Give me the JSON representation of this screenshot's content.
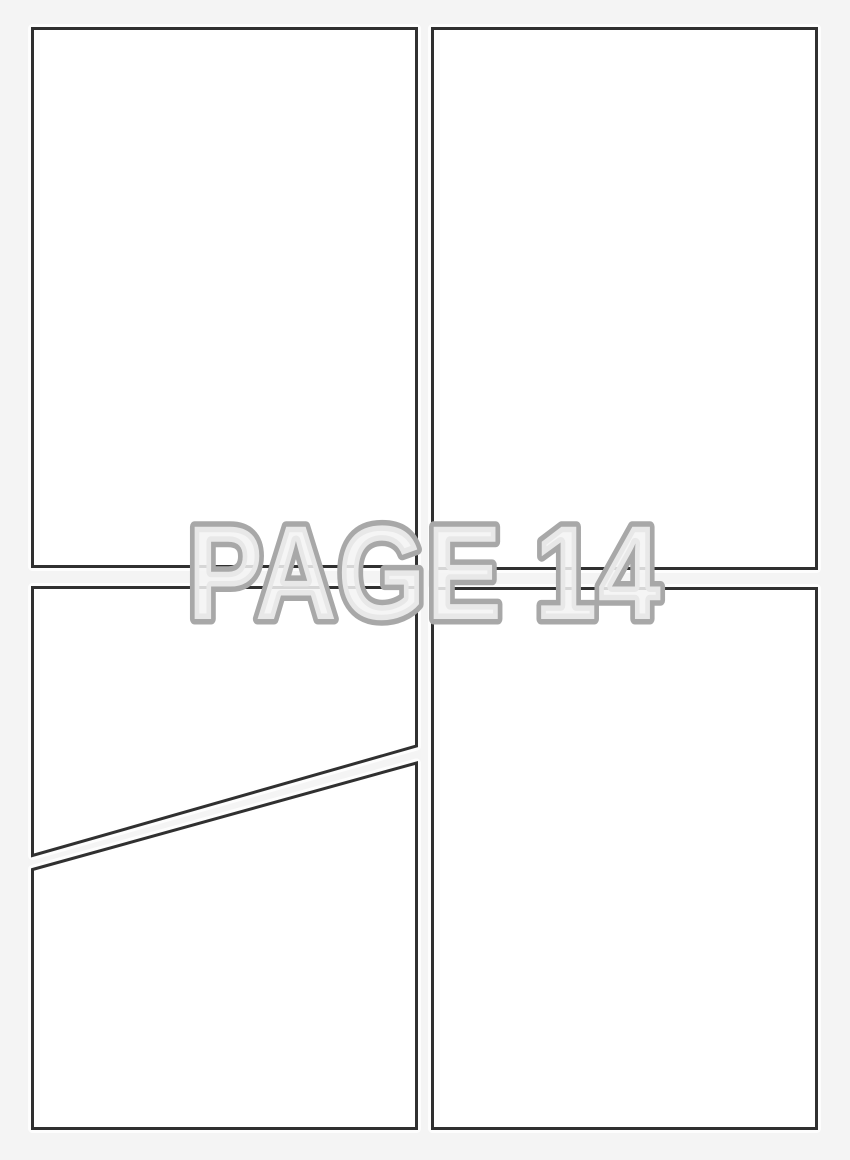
{
  "page": {
    "title_label": "PAGE 14",
    "panel_count": 5,
    "colors": {
      "background": "#f4f4f4",
      "panel_fill": "#ffffff",
      "panel_border": "#303030",
      "panel_halo": "#ffffff",
      "label_fill": "#f3f3f3",
      "label_outline": "#a8a8a8"
    },
    "panels": [
      {
        "name": "panel-top-left"
      },
      {
        "name": "panel-top-right"
      },
      {
        "name": "panel-middle-left"
      },
      {
        "name": "panel-bottom-left"
      },
      {
        "name": "panel-bottom-right"
      }
    ]
  }
}
